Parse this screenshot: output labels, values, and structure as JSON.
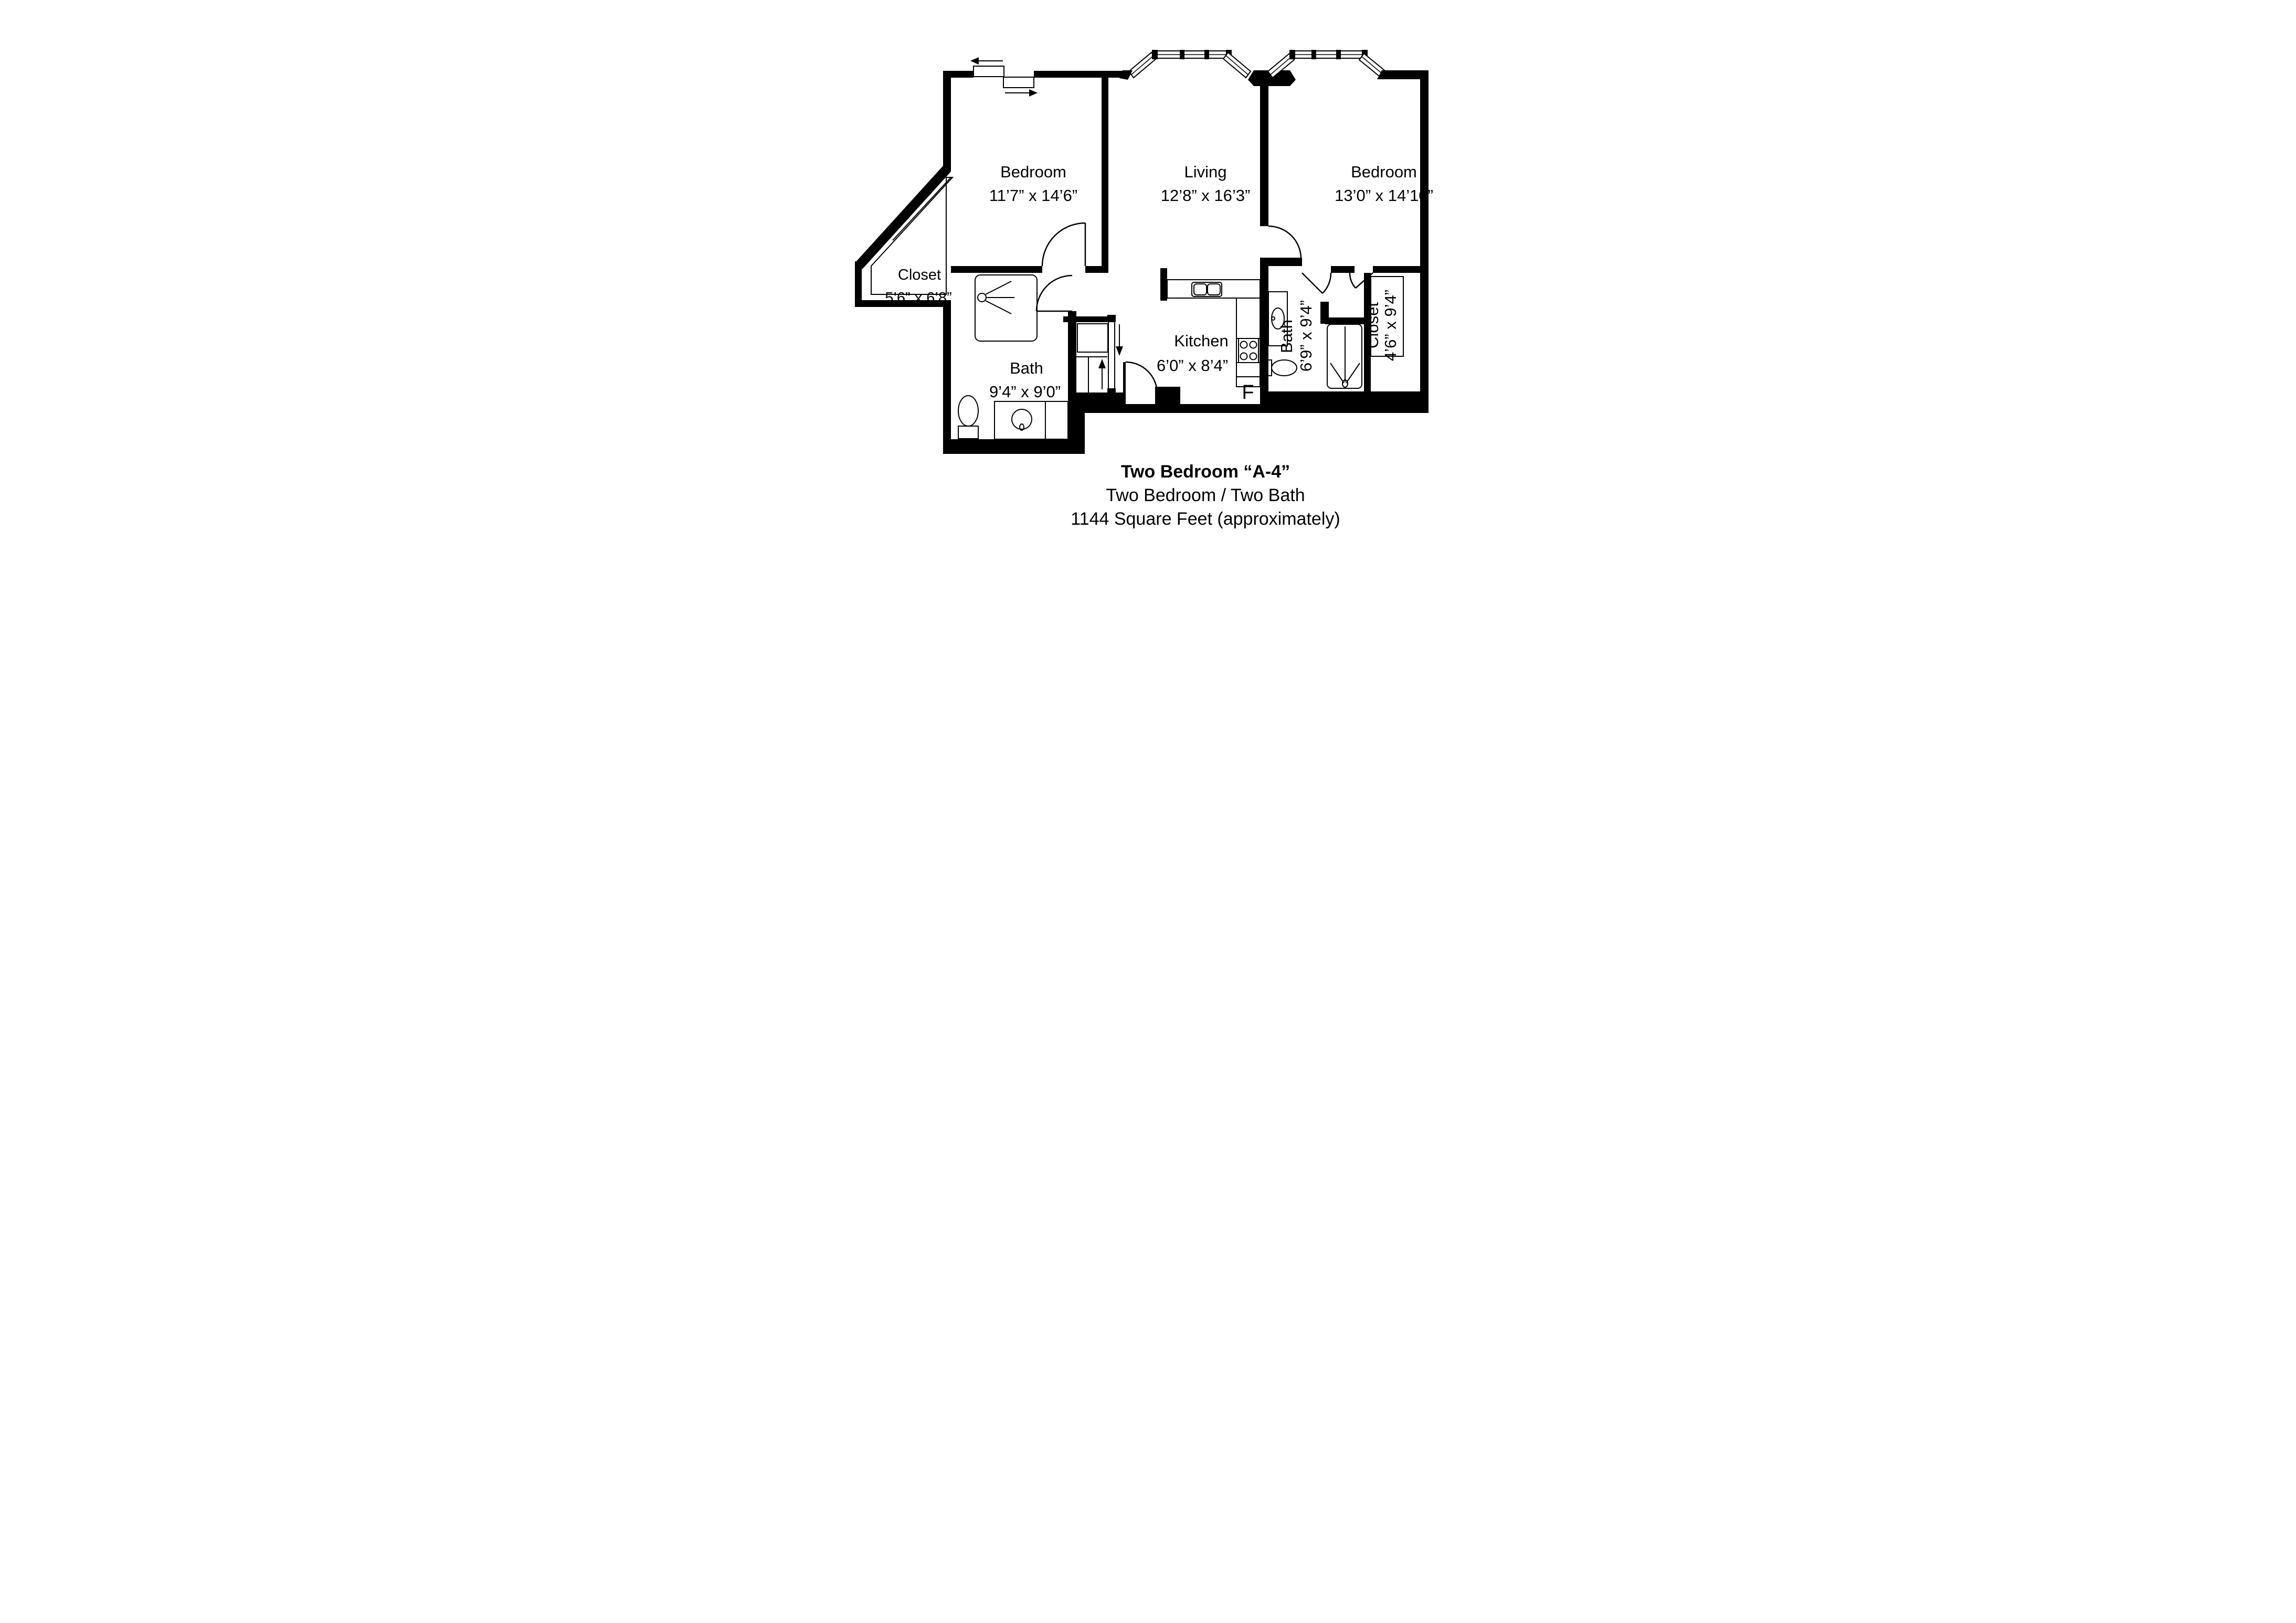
{
  "plan": {
    "rooms": {
      "bedroom1": {
        "name": "Bedroom",
        "dims": "11’7” x 14’6”"
      },
      "living": {
        "name": "Living",
        "dims": "12’8” x 16’3”"
      },
      "bedroom2": {
        "name": "Bedroom",
        "dims": "13’0” x 14’10”"
      },
      "closet1": {
        "name": "Closet",
        "dims": "5’6” x 6’8”"
      },
      "bath1": {
        "name": "Bath",
        "dims": "9’4” x 9’0”"
      },
      "kitchen": {
        "name": "Kitchen",
        "dims": "6’0” x 8’4”"
      },
      "bath2": {
        "name": "Bath",
        "dims": "6’9” x 9’4”"
      },
      "closet2": {
        "name": "Closet",
        "dims": "4’6” x 9’4”"
      }
    },
    "labels": {
      "fridge": "F"
    },
    "title": {
      "line1": "Two Bedroom “A-4”",
      "line2": "Two Bedroom / Two Bath",
      "line3": "1144 Square Feet (approximately)"
    },
    "colors": {
      "walls": "#000000",
      "background": "#ffffff"
    }
  }
}
